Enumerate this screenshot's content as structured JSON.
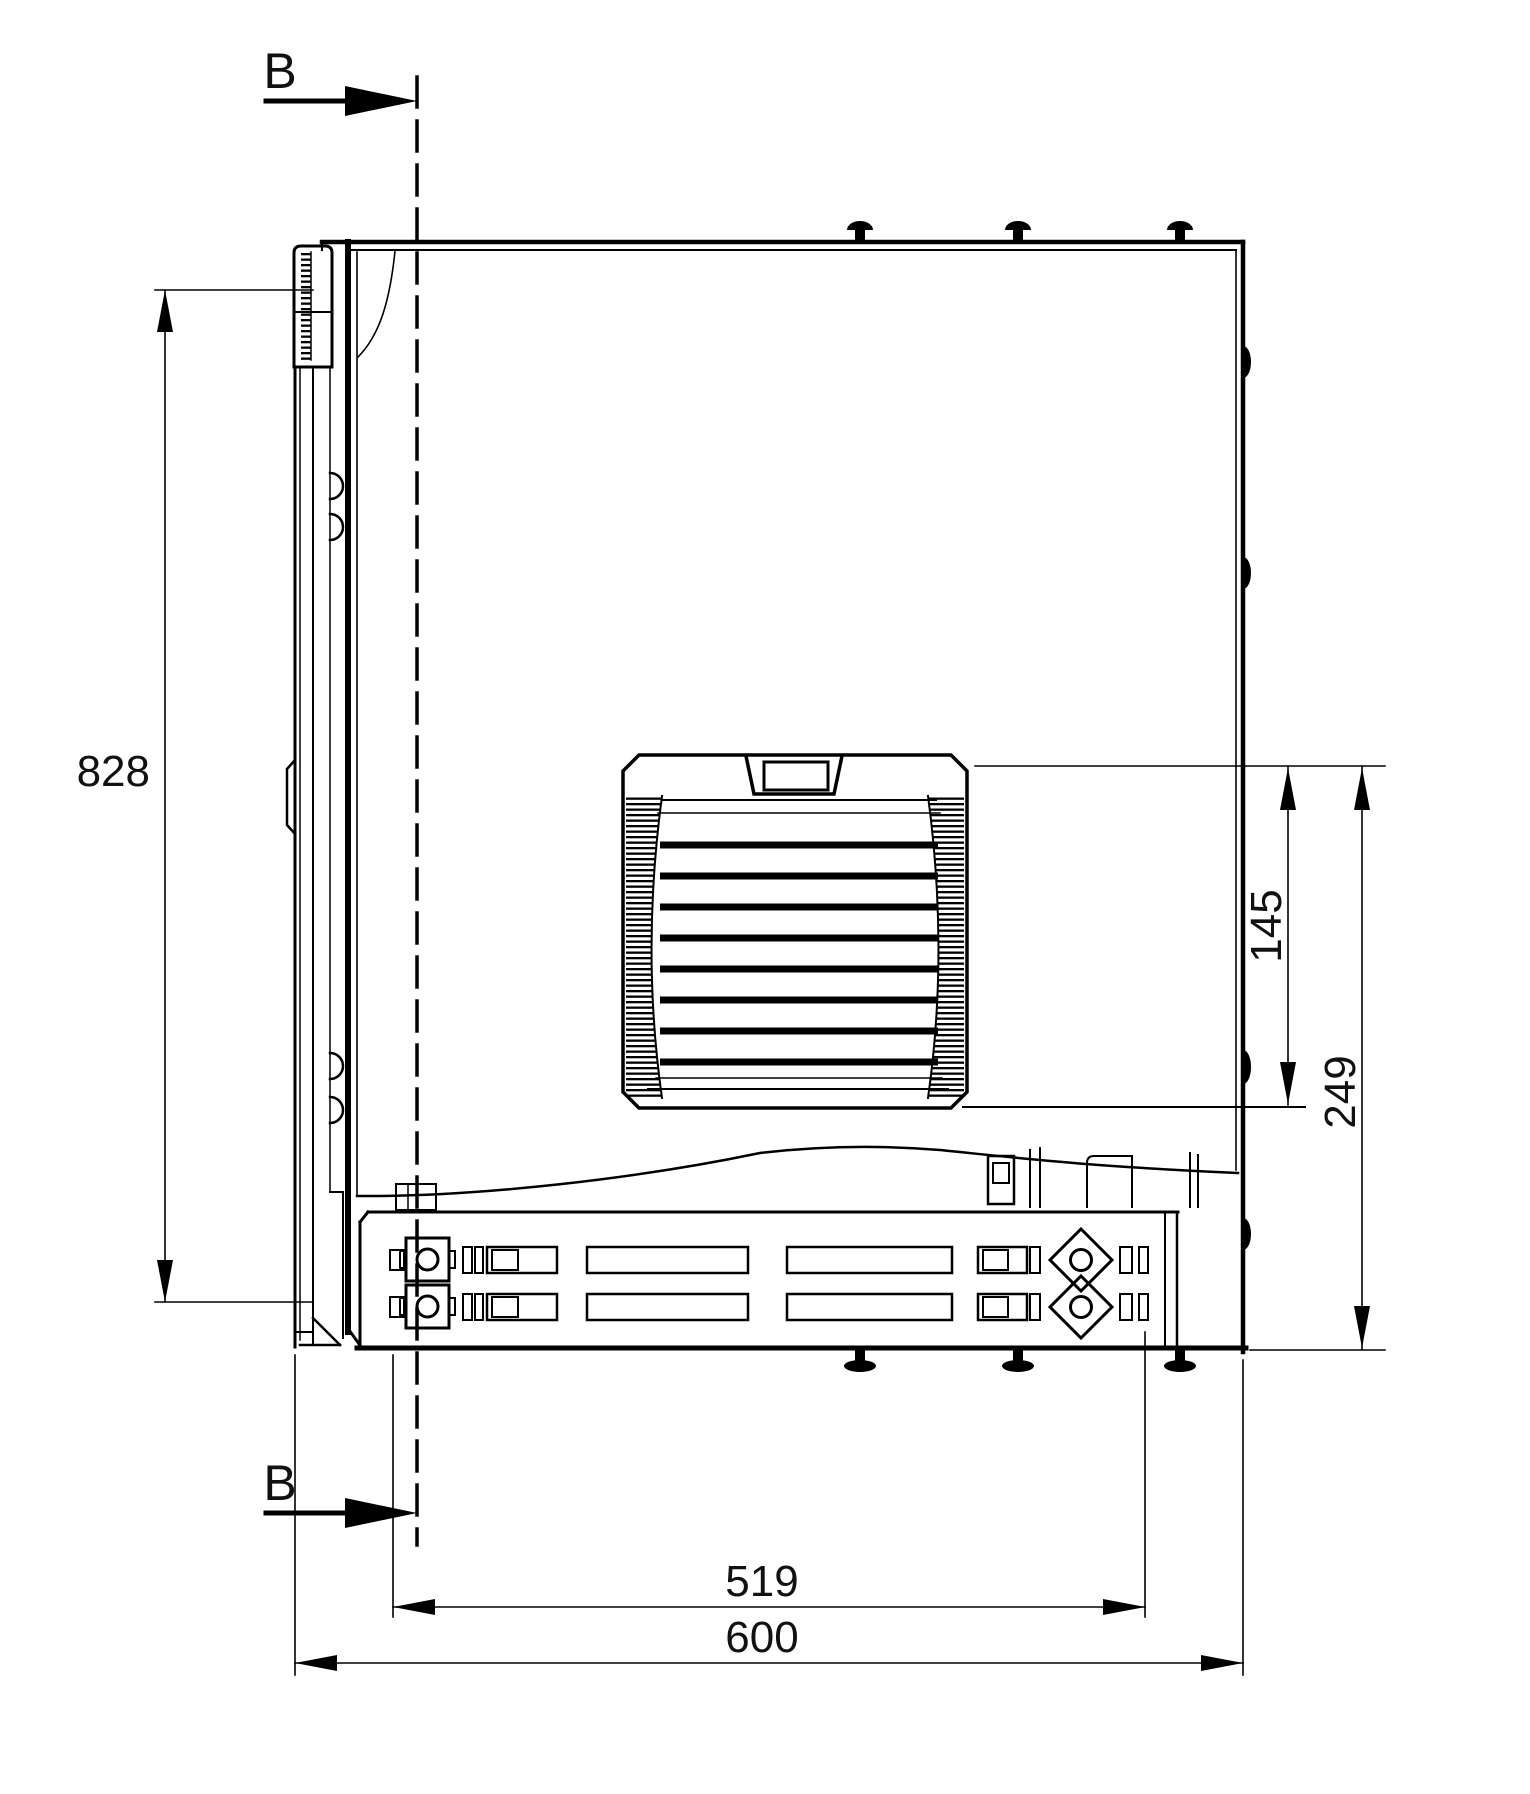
{
  "section_markers": {
    "top": {
      "label": "B"
    },
    "bottom": {
      "label": "B"
    }
  },
  "dimensions": {
    "door_height": {
      "label": "828"
    },
    "vent_height": {
      "label": "145"
    },
    "vent_bottom_offset": {
      "label": "249"
    },
    "base_depth": {
      "label": "519"
    },
    "overall_depth": {
      "label": "600"
    }
  },
  "colors": {
    "line": "#000000",
    "text": "#111111",
    "background": "#ffffff"
  }
}
